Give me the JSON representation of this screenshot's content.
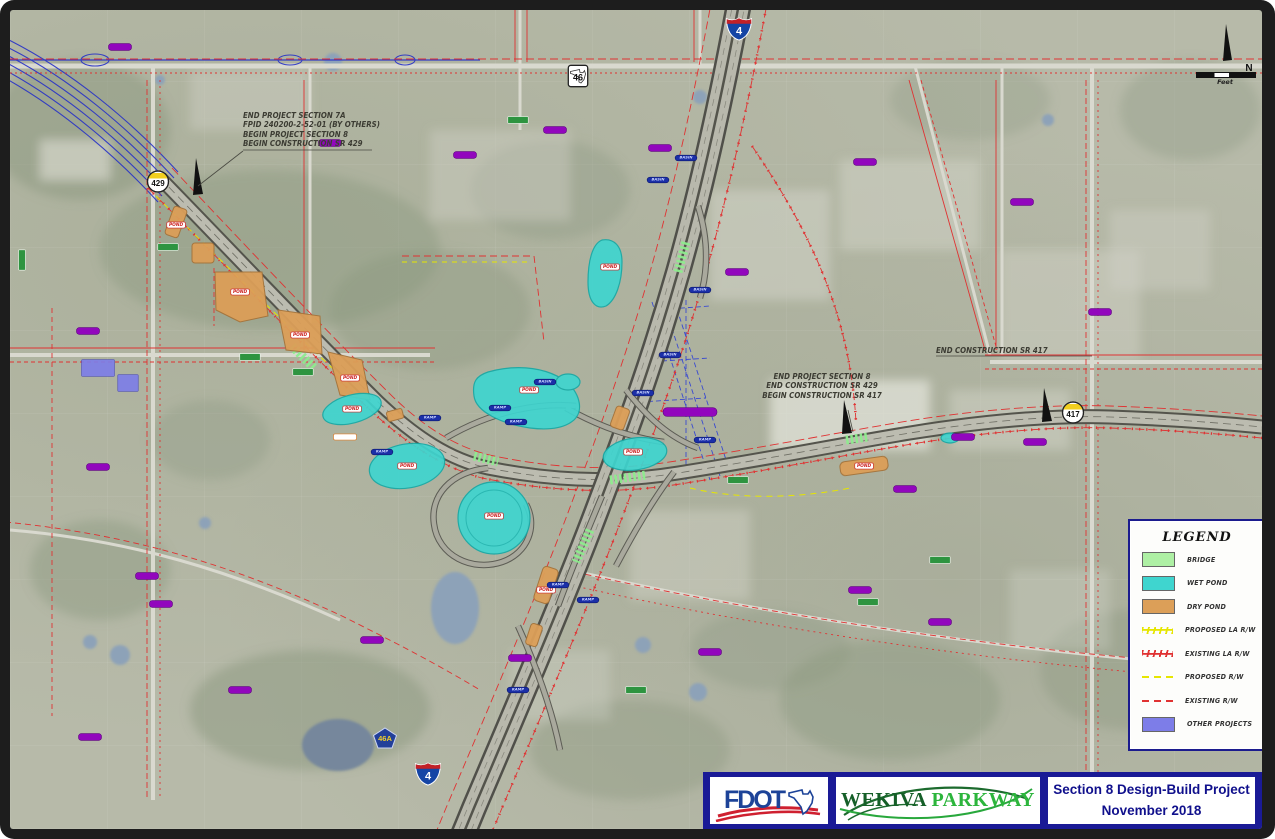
{
  "map": {
    "annotations": {
      "a1": {
        "l1": "END PROJECT SECTION 7A",
        "l2": "FPID 240200-2-52-01 (BY OTHERS)",
        "l3": "BEGIN PROJECT SECTION 8",
        "l4": "BEGIN CONSTRUCTION SR 429"
      },
      "a2": {
        "l1": "END PROJECT SECTION 8",
        "l2": "END CONSTRUCTION SR 429",
        "l3": "BEGIN CONSTRUCTION SR 417"
      },
      "a3": {
        "l1": "END CONSTRUCTION SR 417"
      }
    },
    "shields": {
      "sr46": "46",
      "i4_north": "4",
      "i4_south": "4",
      "cr46a": "46A",
      "sr429": "429",
      "sr417": "417"
    },
    "compass": {
      "north_label": "N",
      "scale_unit": "Feet"
    },
    "markers": [
      {
        "k": "st",
        "x": 110,
        "y": 37
      },
      {
        "k": "st",
        "x": 320,
        "y": 133
      },
      {
        "k": "st",
        "x": 455,
        "y": 145
      },
      {
        "k": "st",
        "x": 650,
        "y": 138
      },
      {
        "k": "st",
        "x": 545,
        "y": 120
      },
      {
        "k": "st",
        "x": 855,
        "y": 152
      },
      {
        "k": "st",
        "x": 1012,
        "y": 192
      },
      {
        "k": "st",
        "x": 1090,
        "y": 302
      },
      {
        "k": "st",
        "x": 727,
        "y": 262
      },
      {
        "k": "st",
        "x": 78,
        "y": 321
      },
      {
        "k": "st",
        "x": 88,
        "y": 457
      },
      {
        "k": "st",
        "x": 137,
        "y": 566
      },
      {
        "k": "st",
        "x": 151,
        "y": 594
      },
      {
        "k": "st",
        "x": 80,
        "y": 727
      },
      {
        "k": "st",
        "x": 230,
        "y": 680
      },
      {
        "k": "st",
        "x": 362,
        "y": 630
      },
      {
        "k": "st",
        "x": 510,
        "y": 648
      },
      {
        "k": "st",
        "x": 953,
        "y": 427
      },
      {
        "k": "st",
        "x": 895,
        "y": 479
      },
      {
        "k": "st",
        "x": 1025,
        "y": 432
      },
      {
        "k": "st",
        "x": 850,
        "y": 580
      },
      {
        "k": "st",
        "x": 930,
        "y": 612
      },
      {
        "k": "st",
        "x": 700,
        "y": 642
      },
      {
        "k": "stw",
        "x": 680,
        "y": 402
      },
      {
        "k": "gn",
        "x": 158,
        "y": 237
      },
      {
        "k": "gn",
        "x": 240,
        "y": 347
      },
      {
        "k": "gn",
        "x": 293,
        "y": 362
      },
      {
        "k": "gn",
        "x": 508,
        "y": 110
      },
      {
        "k": "gn",
        "x": 626,
        "y": 680
      },
      {
        "k": "gn",
        "x": 12,
        "y": 250,
        "r": 90
      },
      {
        "k": "gn",
        "x": 728,
        "y": 470
      },
      {
        "k": "gn",
        "x": 930,
        "y": 550
      },
      {
        "k": "gn",
        "x": 858,
        "y": 592
      },
      {
        "k": "pond",
        "x": 519,
        "y": 380,
        "t": "POND"
      },
      {
        "k": "pond",
        "x": 600,
        "y": 257,
        "t": "POND"
      },
      {
        "k": "pond",
        "x": 342,
        "y": 399,
        "t": "POND"
      },
      {
        "k": "pond",
        "x": 397,
        "y": 456,
        "t": "POND"
      },
      {
        "k": "pond",
        "x": 484,
        "y": 506,
        "t": "POND"
      },
      {
        "k": "pond",
        "x": 623,
        "y": 442,
        "t": "POND"
      },
      {
        "k": "pond",
        "x": 230,
        "y": 282,
        "t": "POND"
      },
      {
        "k": "pond",
        "x": 290,
        "y": 325,
        "t": "POND"
      },
      {
        "k": "pond",
        "x": 340,
        "y": 368,
        "t": "POND"
      },
      {
        "k": "pond",
        "x": 854,
        "y": 456,
        "t": "POND"
      },
      {
        "k": "pond",
        "x": 536,
        "y": 580,
        "t": "POND"
      },
      {
        "k": "pond",
        "x": 166,
        "y": 215,
        "t": "POND"
      },
      {
        "k": "blu",
        "x": 490,
        "y": 398,
        "t": "RAMP"
      },
      {
        "k": "blu",
        "x": 506,
        "y": 412,
        "t": "RAMP"
      },
      {
        "k": "blu",
        "x": 535,
        "y": 372,
        "t": "BASIN"
      },
      {
        "k": "blu",
        "x": 420,
        "y": 408,
        "t": "RAMP"
      },
      {
        "k": "blu",
        "x": 660,
        "y": 345,
        "t": "BASIN"
      },
      {
        "k": "blu",
        "x": 633,
        "y": 383,
        "t": "BASIN"
      },
      {
        "k": "blu",
        "x": 690,
        "y": 280,
        "t": "BASIN"
      },
      {
        "k": "blu",
        "x": 648,
        "y": 170,
        "t": "BASIN"
      },
      {
        "k": "blu",
        "x": 676,
        "y": 148,
        "t": "BASIN"
      },
      {
        "k": "blu",
        "x": 548,
        "y": 575,
        "t": "RAMP"
      },
      {
        "k": "blu",
        "x": 578,
        "y": 590,
        "t": "RAMP"
      },
      {
        "k": "blu",
        "x": 508,
        "y": 680,
        "t": "RAMP"
      },
      {
        "k": "blu",
        "x": 695,
        "y": 430,
        "t": "RAMP"
      },
      {
        "k": "blu",
        "x": 372,
        "y": 442,
        "t": "RAMP"
      },
      {
        "k": "org",
        "x": 335,
        "y": 427
      },
      {
        "k": "prj",
        "x": 88,
        "y": 358,
        "w": 46
      },
      {
        "k": "prj",
        "x": 118,
        "y": 373,
        "w": 26
      }
    ]
  },
  "legend": {
    "title": "LEGEND",
    "items": [
      {
        "label": "BRIDGE",
        "style": "fill",
        "color": "#aef0a4"
      },
      {
        "label": "WET POND",
        "style": "fill",
        "color": "#3fd5cf"
      },
      {
        "label": "DRY POND",
        "style": "fill",
        "color": "#dc9f58"
      },
      {
        "label": "PROPOSED LA R/W",
        "style": "hatch",
        "color": "#e6e600"
      },
      {
        "label": "EXISTING LA R/W",
        "style": "hatch",
        "color": "#e03232"
      },
      {
        "label": "PROPOSED R/W",
        "style": "dash",
        "color": "#e6e600"
      },
      {
        "label": "EXISTING R/W",
        "style": "dash",
        "color": "#e03232"
      },
      {
        "label": "OTHER PROJECTS",
        "style": "fill",
        "color": "#7d7de8"
      }
    ]
  },
  "title_block": {
    "agency": "FDOT",
    "project_word1": "WEKIVA",
    "project_word2": "PARKWAY",
    "line1": "Section 8 Design-Build Project",
    "line2": "November 2018"
  },
  "colors": {
    "wet_pond": "#3fd5cf",
    "dry_pond": "#dc9f58",
    "bridge": "#aef0a4",
    "other_projects": "#7d7de8",
    "existing_rw": "#e03232",
    "proposed_rw": "#e6e600",
    "title_bar": "#1a1a96",
    "frame": "#1d1d1d"
  }
}
